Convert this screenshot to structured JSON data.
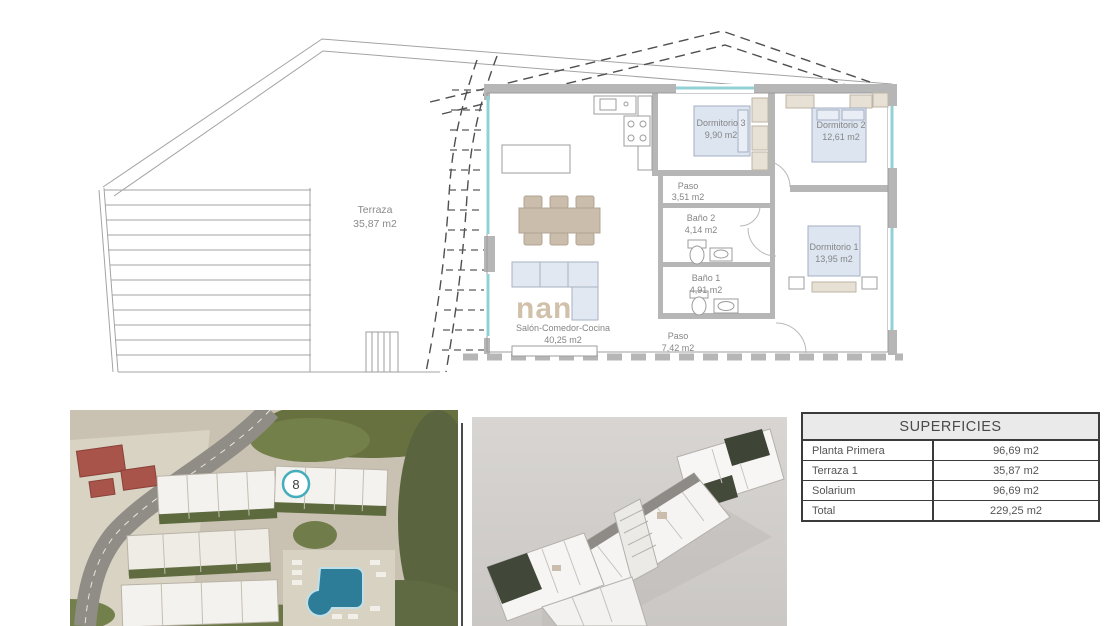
{
  "floor_plan": {
    "rooms": {
      "terraza": {
        "name": "Terraza",
        "area": "35,87 m2"
      },
      "salon": {
        "name": "Salón-Comedor-Cocina",
        "area": "40,25 m2"
      },
      "dormitorio3": {
        "name": "Dormitorio 3",
        "area": "9,90 m2"
      },
      "dormitorio2": {
        "name": "Dormitorio 2",
        "area": "12,61 m2"
      },
      "dormitorio1": {
        "name": "Dormitorio 1",
        "area": "13,95 m2"
      },
      "paso1": {
        "name": "Paso",
        "area": "3,51 m2"
      },
      "bano2": {
        "name": "Baño 2",
        "area": "4,14 m2"
      },
      "bano1": {
        "name": "Baño 1",
        "area": "4,91 m2"
      },
      "paso2": {
        "name": "Paso",
        "area": "7,42 m2"
      }
    },
    "watermark": "nan"
  },
  "site_plan": {
    "unit_marker": "8"
  },
  "areas_table": {
    "title": "SUPERFICIES",
    "rows": [
      {
        "label": "Planta Primera",
        "value": "96,69 m2"
      },
      {
        "label": "Terraza 1",
        "value": "35,87 m2"
      },
      {
        "label": "Solarium",
        "value": "96,69 m2"
      },
      {
        "label": "Total",
        "value": "229,25 m2"
      }
    ]
  },
  "colors": {
    "wall_gray": "#b6b6b6",
    "window_teal": "#93d2d4",
    "bed_blue": "#dce5f0",
    "furniture_beige": "#cabdab",
    "marker_teal": "#45aebd",
    "table_border": "#3b3b3b",
    "table_header_bg": "#eaeaea",
    "pool_blue": "#2e7d98"
  }
}
